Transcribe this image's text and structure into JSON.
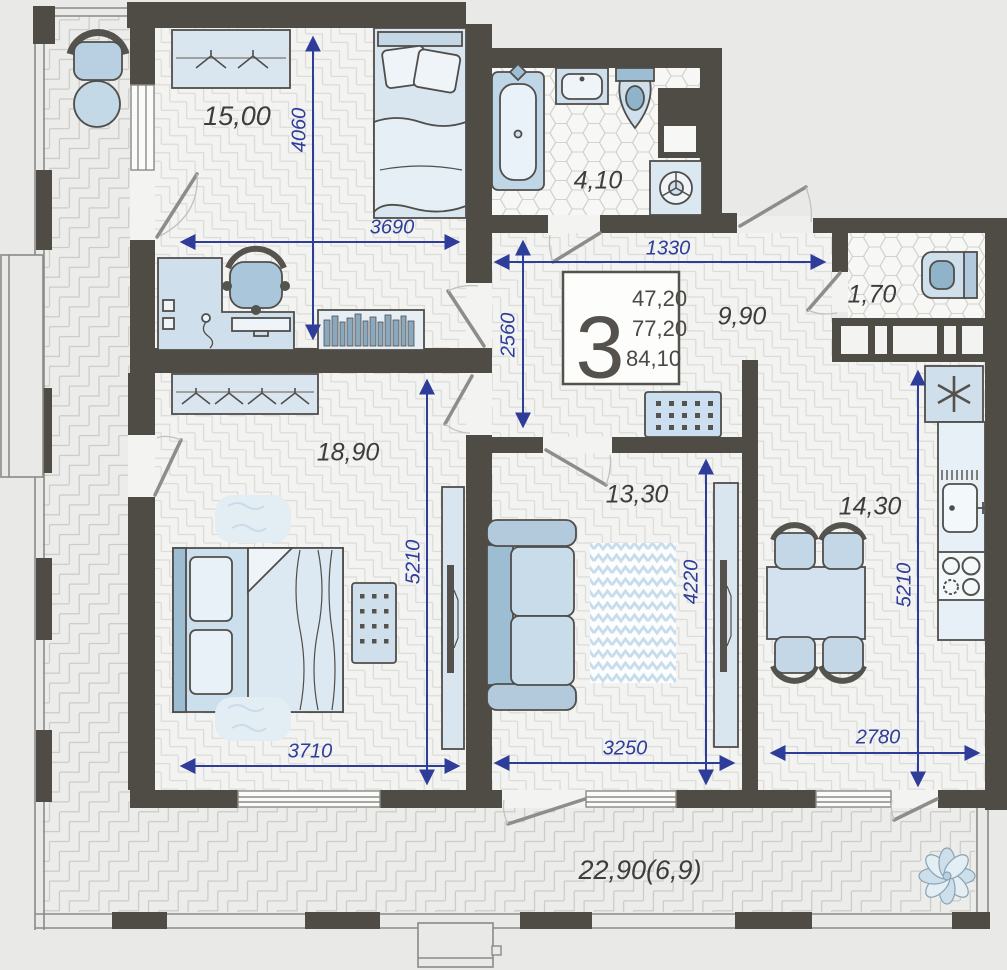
{
  "unit": {
    "rooms_count": "3",
    "areas": [
      "47,20",
      "77,20",
      "84,10"
    ]
  },
  "rooms": [
    {
      "name": "bedroom",
      "label": "15,00"
    },
    {
      "name": "bathroom",
      "label": "4,10"
    },
    {
      "name": "hallway",
      "label": "9,90"
    },
    {
      "name": "wc",
      "label": "1,70"
    },
    {
      "name": "bedroom-master",
      "label": "18,90"
    },
    {
      "name": "living-room",
      "label": "13,30"
    },
    {
      "name": "kitchen",
      "label": "14,30"
    },
    {
      "name": "terrace",
      "label": "22,90(6,9)"
    }
  ],
  "dimensions_mm": {
    "d4060": "4060",
    "d3690": "3690",
    "d1330": "1330",
    "d2560": "2560",
    "d5210_bedroom": "5210",
    "d3710": "3710",
    "d4220": "4220",
    "d3250": "3250",
    "d5210_kitchen": "5210",
    "d2780": "2780"
  },
  "colors": {
    "wall": "#4f4b45",
    "dimension": "#2e3d9a",
    "floor": "#f3f3f1",
    "terrace_floor": "#ececea",
    "furniture_light": "#cfe0ec",
    "furniture_mid": "#9dbdd3",
    "background": "#e9e9e8"
  },
  "furniture_icons": [
    "armchair",
    "coffee-table",
    "wardrobe",
    "single-bed",
    "desk",
    "office-chair",
    "bookshelf",
    "bathtub",
    "washbasin",
    "toilet",
    "washing-machine",
    "ventilation-shaft",
    "shoe-cabinet",
    "double-bed",
    "rug",
    "radiator",
    "tv-cabinet",
    "sofa",
    "zigzag-rug",
    "dining-table",
    "dining-chair",
    "fridge",
    "kitchen-sink",
    "stove",
    "plant"
  ]
}
